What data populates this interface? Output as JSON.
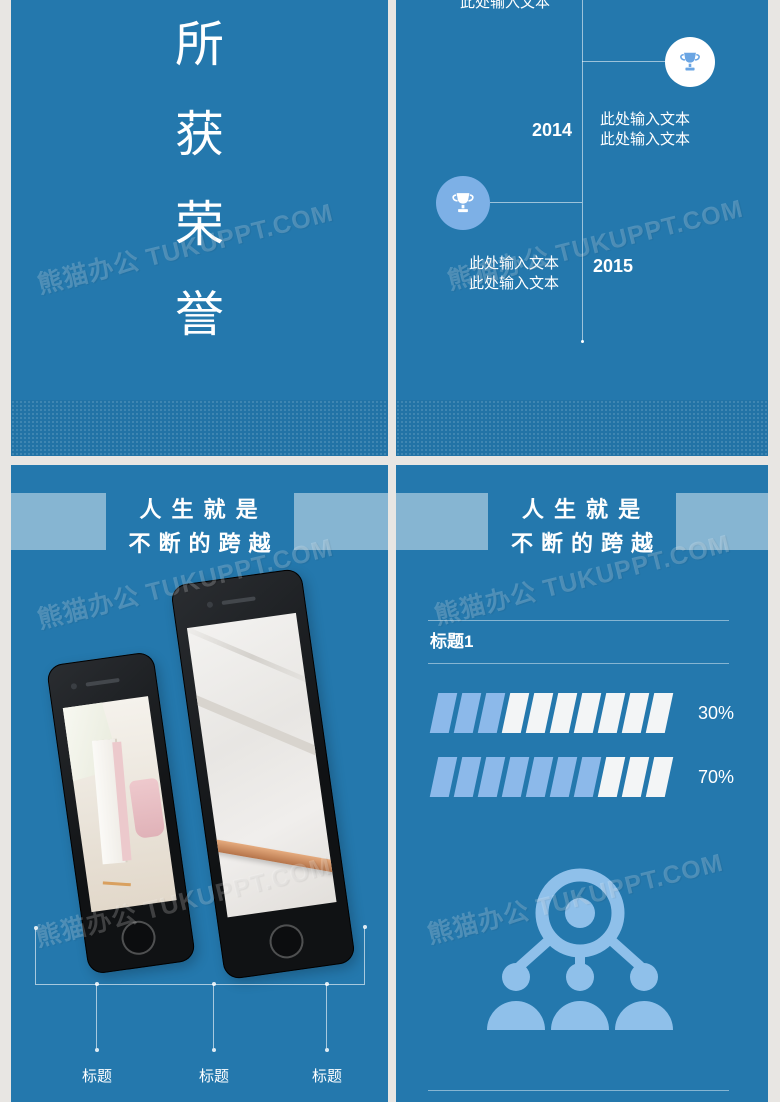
{
  "watermark": {
    "text": "熊猫办公 TUKUPPT.COM"
  },
  "colors": {
    "slide_bg": "#2478ad",
    "title_band": "rgba(255,255,255,0.45)",
    "icon_light_blue": "#8fc0ea",
    "segment_filled_blue": "#8cb9ea",
    "segment_empty_white": "#f3f5f6",
    "trophy_blue": "#6aa5e3",
    "timeline_circle_blue": "#7db0e6"
  },
  "honors_slide": {
    "title_chars": [
      "所",
      "获",
      "荣",
      "誉"
    ]
  },
  "timeline_slide": {
    "partial_text_top": "此处输入文本",
    "items": [
      {
        "year": "2014",
        "desc_line1": "此处输入文本",
        "desc_line2": "此处输入文本"
      },
      {
        "year": "2015",
        "desc_line1": "此处输入文本",
        "desc_line2": "此处输入文本"
      }
    ]
  },
  "leap_slide_phones": {
    "title_line1": "人 生 就 是",
    "title_line2": "不断的跨越",
    "captions": [
      "标题",
      "标题",
      "标题"
    ]
  },
  "leap_slide_stats": {
    "title_line1": "人 生 就 是",
    "title_line2": "不断的跨越",
    "section_title": "标题1",
    "chart_data": {
      "type": "bar",
      "unit": "percent",
      "bars": [
        {
          "label": "30%",
          "value": 30,
          "segments_total": 10,
          "segments_filled": 3
        },
        {
          "label": "70%",
          "value": 70,
          "segments_total": 10,
          "segments_filled": 7
        }
      ]
    }
  }
}
